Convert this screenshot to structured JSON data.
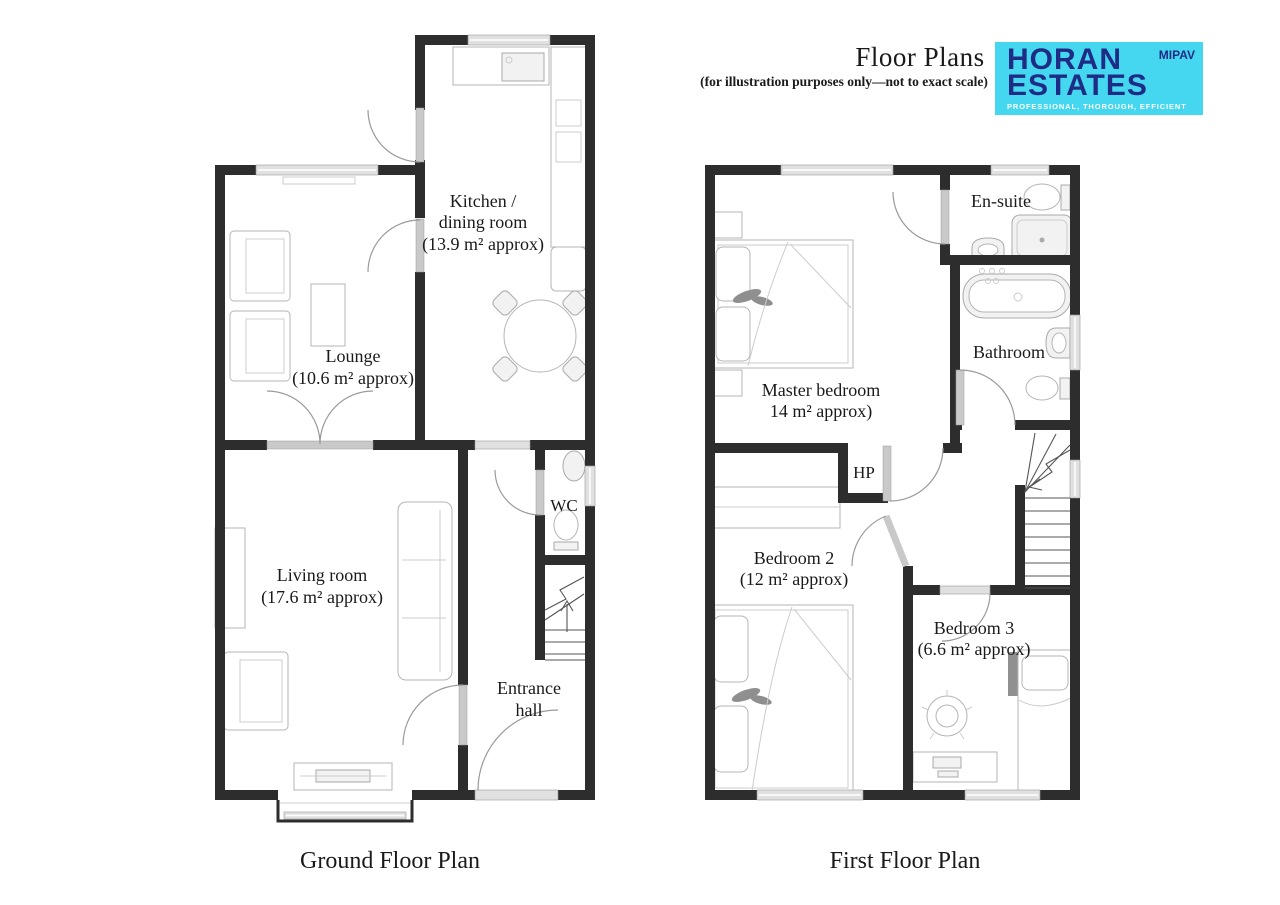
{
  "header": {
    "title": "Floor Plans",
    "subtitle": "(for illustration purposes only—not to exact scale)",
    "logo": {
      "name_line1": "HORAN",
      "name_line2": "ESTATES",
      "badge": "MIPAV",
      "tagline": "PROFESSIONAL, THOROUGH, EFFICIENT",
      "colors": {
        "background": "#45d7f0",
        "text": "#1e2c85",
        "tagline_text": "#ffffff"
      }
    }
  },
  "ground_floor": {
    "title": "Ground Floor Plan",
    "rooms": {
      "kitchen": {
        "lines": [
          "Kitchen /",
          "dining room",
          "(13.9 m² approx)"
        ]
      },
      "lounge": {
        "lines": [
          "Lounge",
          "(10.6 m² approx)"
        ]
      },
      "living_room": {
        "lines": [
          "Living room",
          "(17.6 m² approx)"
        ]
      },
      "wc": {
        "lines": [
          "WC"
        ]
      },
      "entrance_hall": {
        "lines": [
          "Entrance",
          "hall"
        ]
      }
    }
  },
  "first_floor": {
    "title": "First Floor Plan",
    "rooms": {
      "master_bedroom": {
        "lines": [
          "Master bedroom",
          "14 m² approx)"
        ]
      },
      "en_suite": {
        "lines": [
          "En-suite"
        ]
      },
      "bathroom": {
        "lines": [
          "Bathroom"
        ]
      },
      "hp": {
        "lines": [
          "HP"
        ]
      },
      "bedroom_2": {
        "lines": [
          "Bedroom 2",
          "(12 m² approx)"
        ]
      },
      "bedroom_3": {
        "lines": [
          "Bedroom 3",
          "(6.6 m² approx)"
        ]
      }
    }
  },
  "colors": {
    "wall": "#2d2d2d",
    "window": "#e0e0e0",
    "door_leaf": "#c9c9c9",
    "door_arc": "#9a9a9a",
    "furniture_outline": "#b5b5b5",
    "text": "#1a1a1a",
    "background": "#ffffff"
  }
}
